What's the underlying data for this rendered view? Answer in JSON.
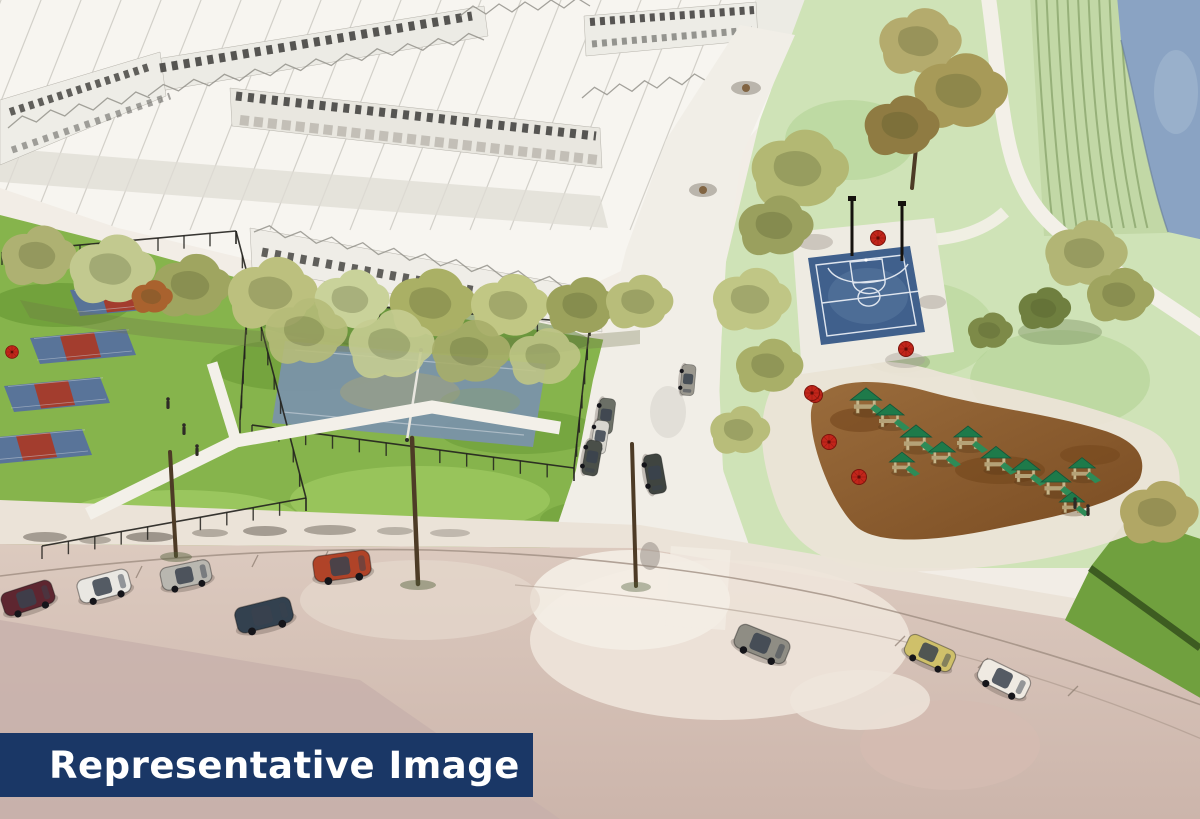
{
  "banner": {
    "text": "Representative Image",
    "background": "#1a3766",
    "text_color": "#ffffff"
  },
  "scene": {
    "description": "Aerial watercolor architectural rendering of a planned neighborhood: townhouse rows, tree-lined lane, pickleball and tennis courts, basketball court, playground with umbrellas, terraced lawn beside a pond, and a curving road with parked cars",
    "features": [
      "townhouse-rows",
      "tree-row",
      "pickleball-courts",
      "tennis-court",
      "central-street",
      "basketball-court",
      "playground",
      "picnic-umbrellas",
      "terraced-lawn",
      "pond",
      "walking-paths",
      "road-with-cars"
    ],
    "counts": {
      "pickleball_courts": 4,
      "cars_on_road": 8
    }
  },
  "palette": {
    "banner_navy": "#1a3766",
    "lawn_green": "#86b44c",
    "park_green": "#cfe3b7",
    "basketball_blue": "#40608c",
    "pickleball_blue": "#56719d",
    "pickleball_red": "#a83a28",
    "mulch_brown": "#8a5c2e",
    "road_beige": "#d8c5bb",
    "water_blue": "#8aa3c3",
    "umbrella_red": "#c2251a"
  }
}
